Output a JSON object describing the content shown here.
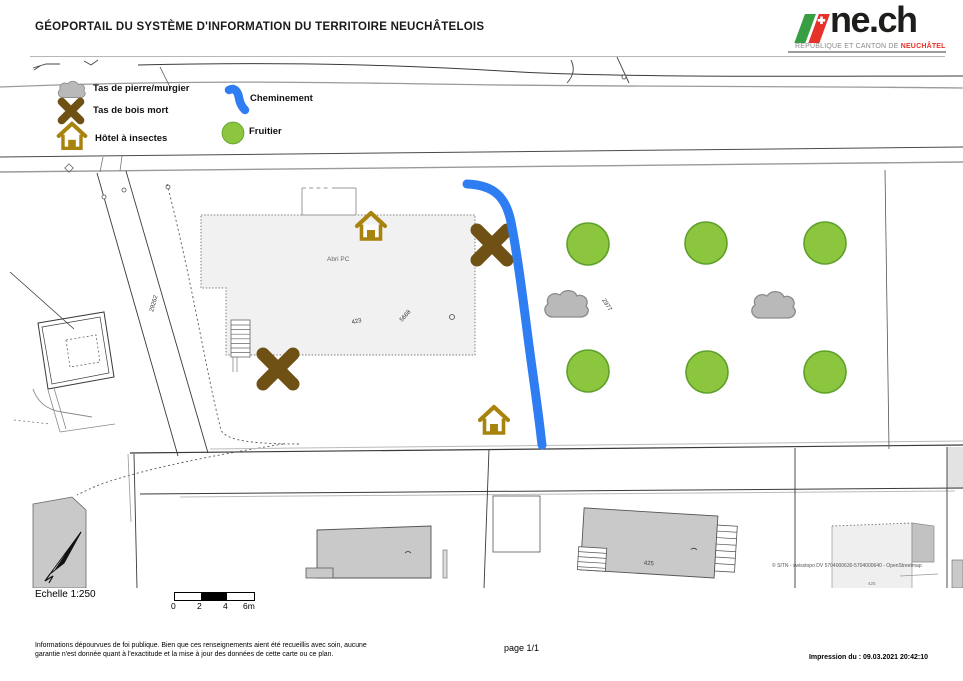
{
  "header": {
    "title": "GÉOPORTAIL DU SYSTÈME D'INFORMATION DU TERRITOIRE NEUCHÂTELOIS",
    "logo": {
      "brand": "ne.ch",
      "tagline_prefix": "RÉPUBLIQUE ET CANTON DE ",
      "tagline_emphasis": "NEUCHÂTEL",
      "colors": {
        "green": "#379e43",
        "red": "#e63329",
        "text": "#1d1d1b"
      }
    }
  },
  "legend": {
    "items": [
      {
        "icon": "cloud-icon",
        "label": "Tas de pierre/murgier"
      },
      {
        "icon": "x-icon",
        "label": "Tas de bois mort"
      },
      {
        "icon": "house-icon",
        "label": "Hôtel à insectes"
      },
      {
        "icon": "path-icon",
        "label": "Cheminement"
      },
      {
        "icon": "circle-icon",
        "label": "Fruitier"
      }
    ]
  },
  "map": {
    "labels": {
      "abri": "Abri PC",
      "p423": "423",
      "p5668": "5668",
      "p2977": "2977",
      "p29262": "29262",
      "b425": "425",
      "b425_small": "425",
      "copyright": "© SITN - swisstopo DV 5704000630-5704000640 - OpenStreetmap"
    },
    "colors": {
      "tree_fill": "#8cc63e",
      "tree_stroke": "#5fa02a",
      "cloud_fill": "#b9b9b9",
      "wood_x": "#6f5116",
      "house": "#a8830d",
      "path_blue": "#2e7df2",
      "building_fill": "#c9c9c9",
      "abri_fill": "#f1f1f1"
    },
    "features": {
      "fruit_trees": 6,
      "stone_piles": 2,
      "dead_wood_piles": 2,
      "insect_hotels": 2,
      "paths": 1
    }
  },
  "scale": {
    "label": "Echelle 1:250",
    "ticks": [
      "0",
      "2",
      "4",
      "6m"
    ]
  },
  "footer": {
    "disclaimer_line1": "Informations dépourvues de foi publique. Bien que ces renseignements aient été recueillis avec soin, aucune",
    "disclaimer_line2": "garantie n'est donnée quant à l'exactitude et la mise à jour des données de cette carte ou ce plan.",
    "page": "page 1/1",
    "print_date": "Impression du : 09.03.2021 20:42:10"
  }
}
